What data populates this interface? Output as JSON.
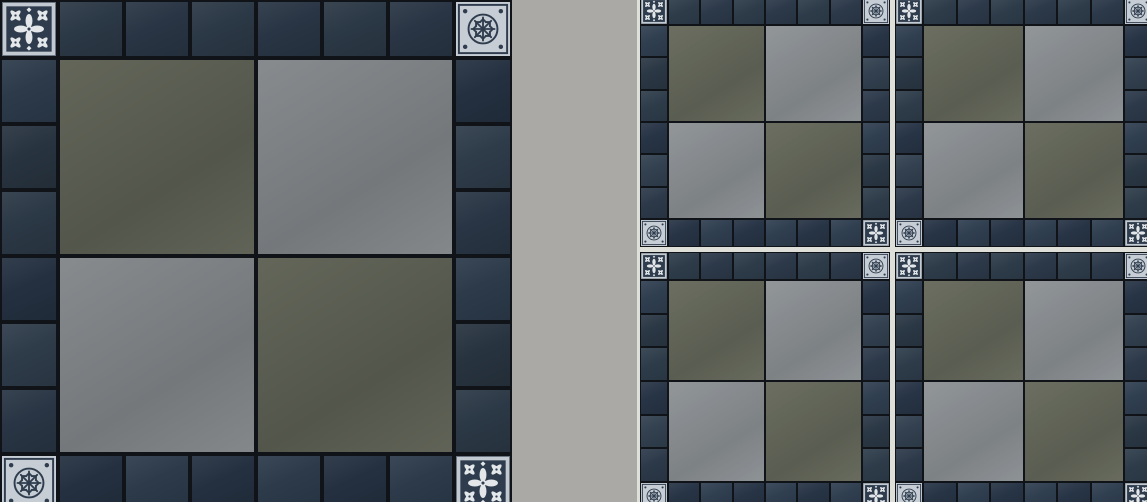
{
  "scene": {
    "type": "tile-pattern-preview",
    "left_panel_label": "single module detail",
    "right_panel_label": "pattern repeat layout"
  },
  "colors": {
    "canvas_background": "#aaa9a5",
    "grout_dark": "#101318",
    "grout_light": "#dedfd9",
    "border_tile_shades": [
      "#27333f",
      "#2b3845",
      "#243040",
      "#2e3b49",
      "#293544",
      "#2c3a4a"
    ],
    "paver_olive": "#53564b",
    "paver_olive_hi": "#636659",
    "paver_gray": "#74787b",
    "paver_gray_hi": "#878b8e",
    "ornament_frame": "#c2c9d0",
    "ornament_dark": "#2e3c4d",
    "ornament_motif": "#e3e7ea",
    "ornament_light_bg": "#c6cdd5"
  },
  "module": {
    "border_tiles_per_side": 6,
    "corners": {
      "top_left": "floral",
      "top_right": "snowflake",
      "bottom_left": "snowflake",
      "bottom_right": "floral"
    },
    "pavers": [
      [
        "olive",
        "gray"
      ],
      [
        "gray",
        "olive"
      ]
    ]
  },
  "left_panel": {
    "modules_x": 1,
    "modules_y": 1,
    "module_size_px": 512
  },
  "right_panel": {
    "modules_x": 2,
    "modules_y": 2,
    "module_size_px": 250
  }
}
